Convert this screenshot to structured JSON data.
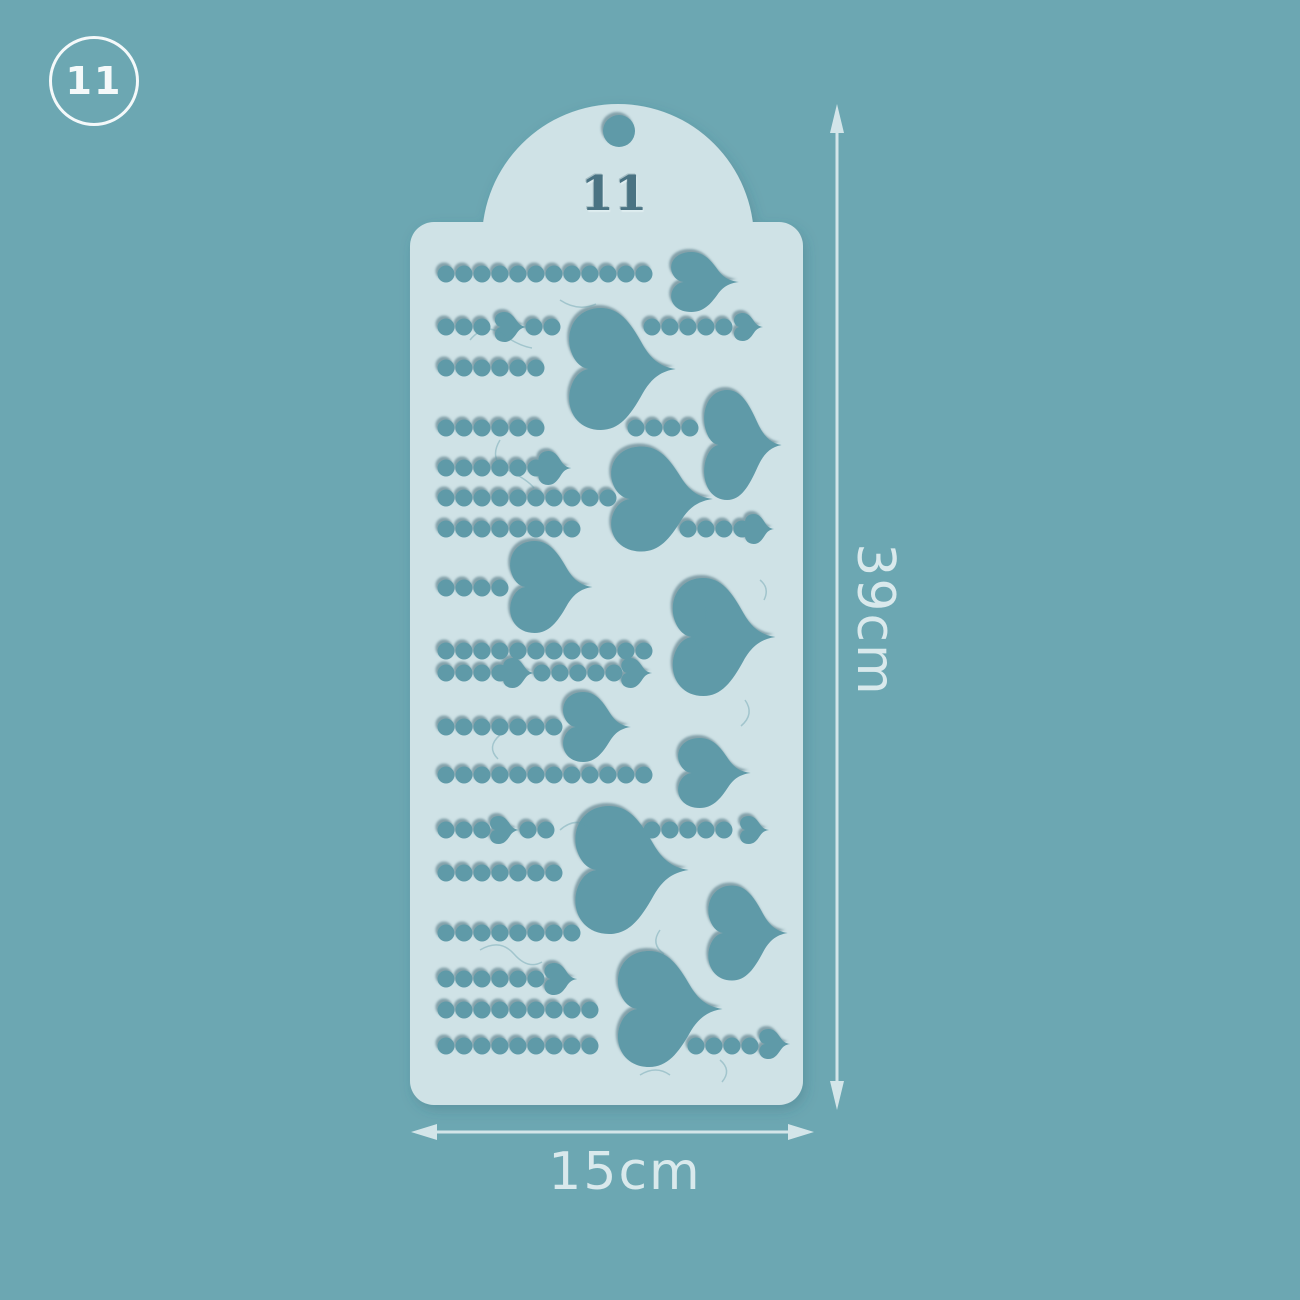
{
  "badge": {
    "number": "11"
  },
  "stencil": {
    "engraved_number": "11"
  },
  "dimensions": {
    "height_label": "39cm",
    "width_label": "15cm"
  },
  "colors": {
    "background": "#6ca7b2",
    "stencil": "#cfe2e6",
    "cutout": "#5f9aa8",
    "engraved_number": "#4a7383",
    "dimension_annotation": "#d9e9ec",
    "badge": "#f4f9fa"
  }
}
